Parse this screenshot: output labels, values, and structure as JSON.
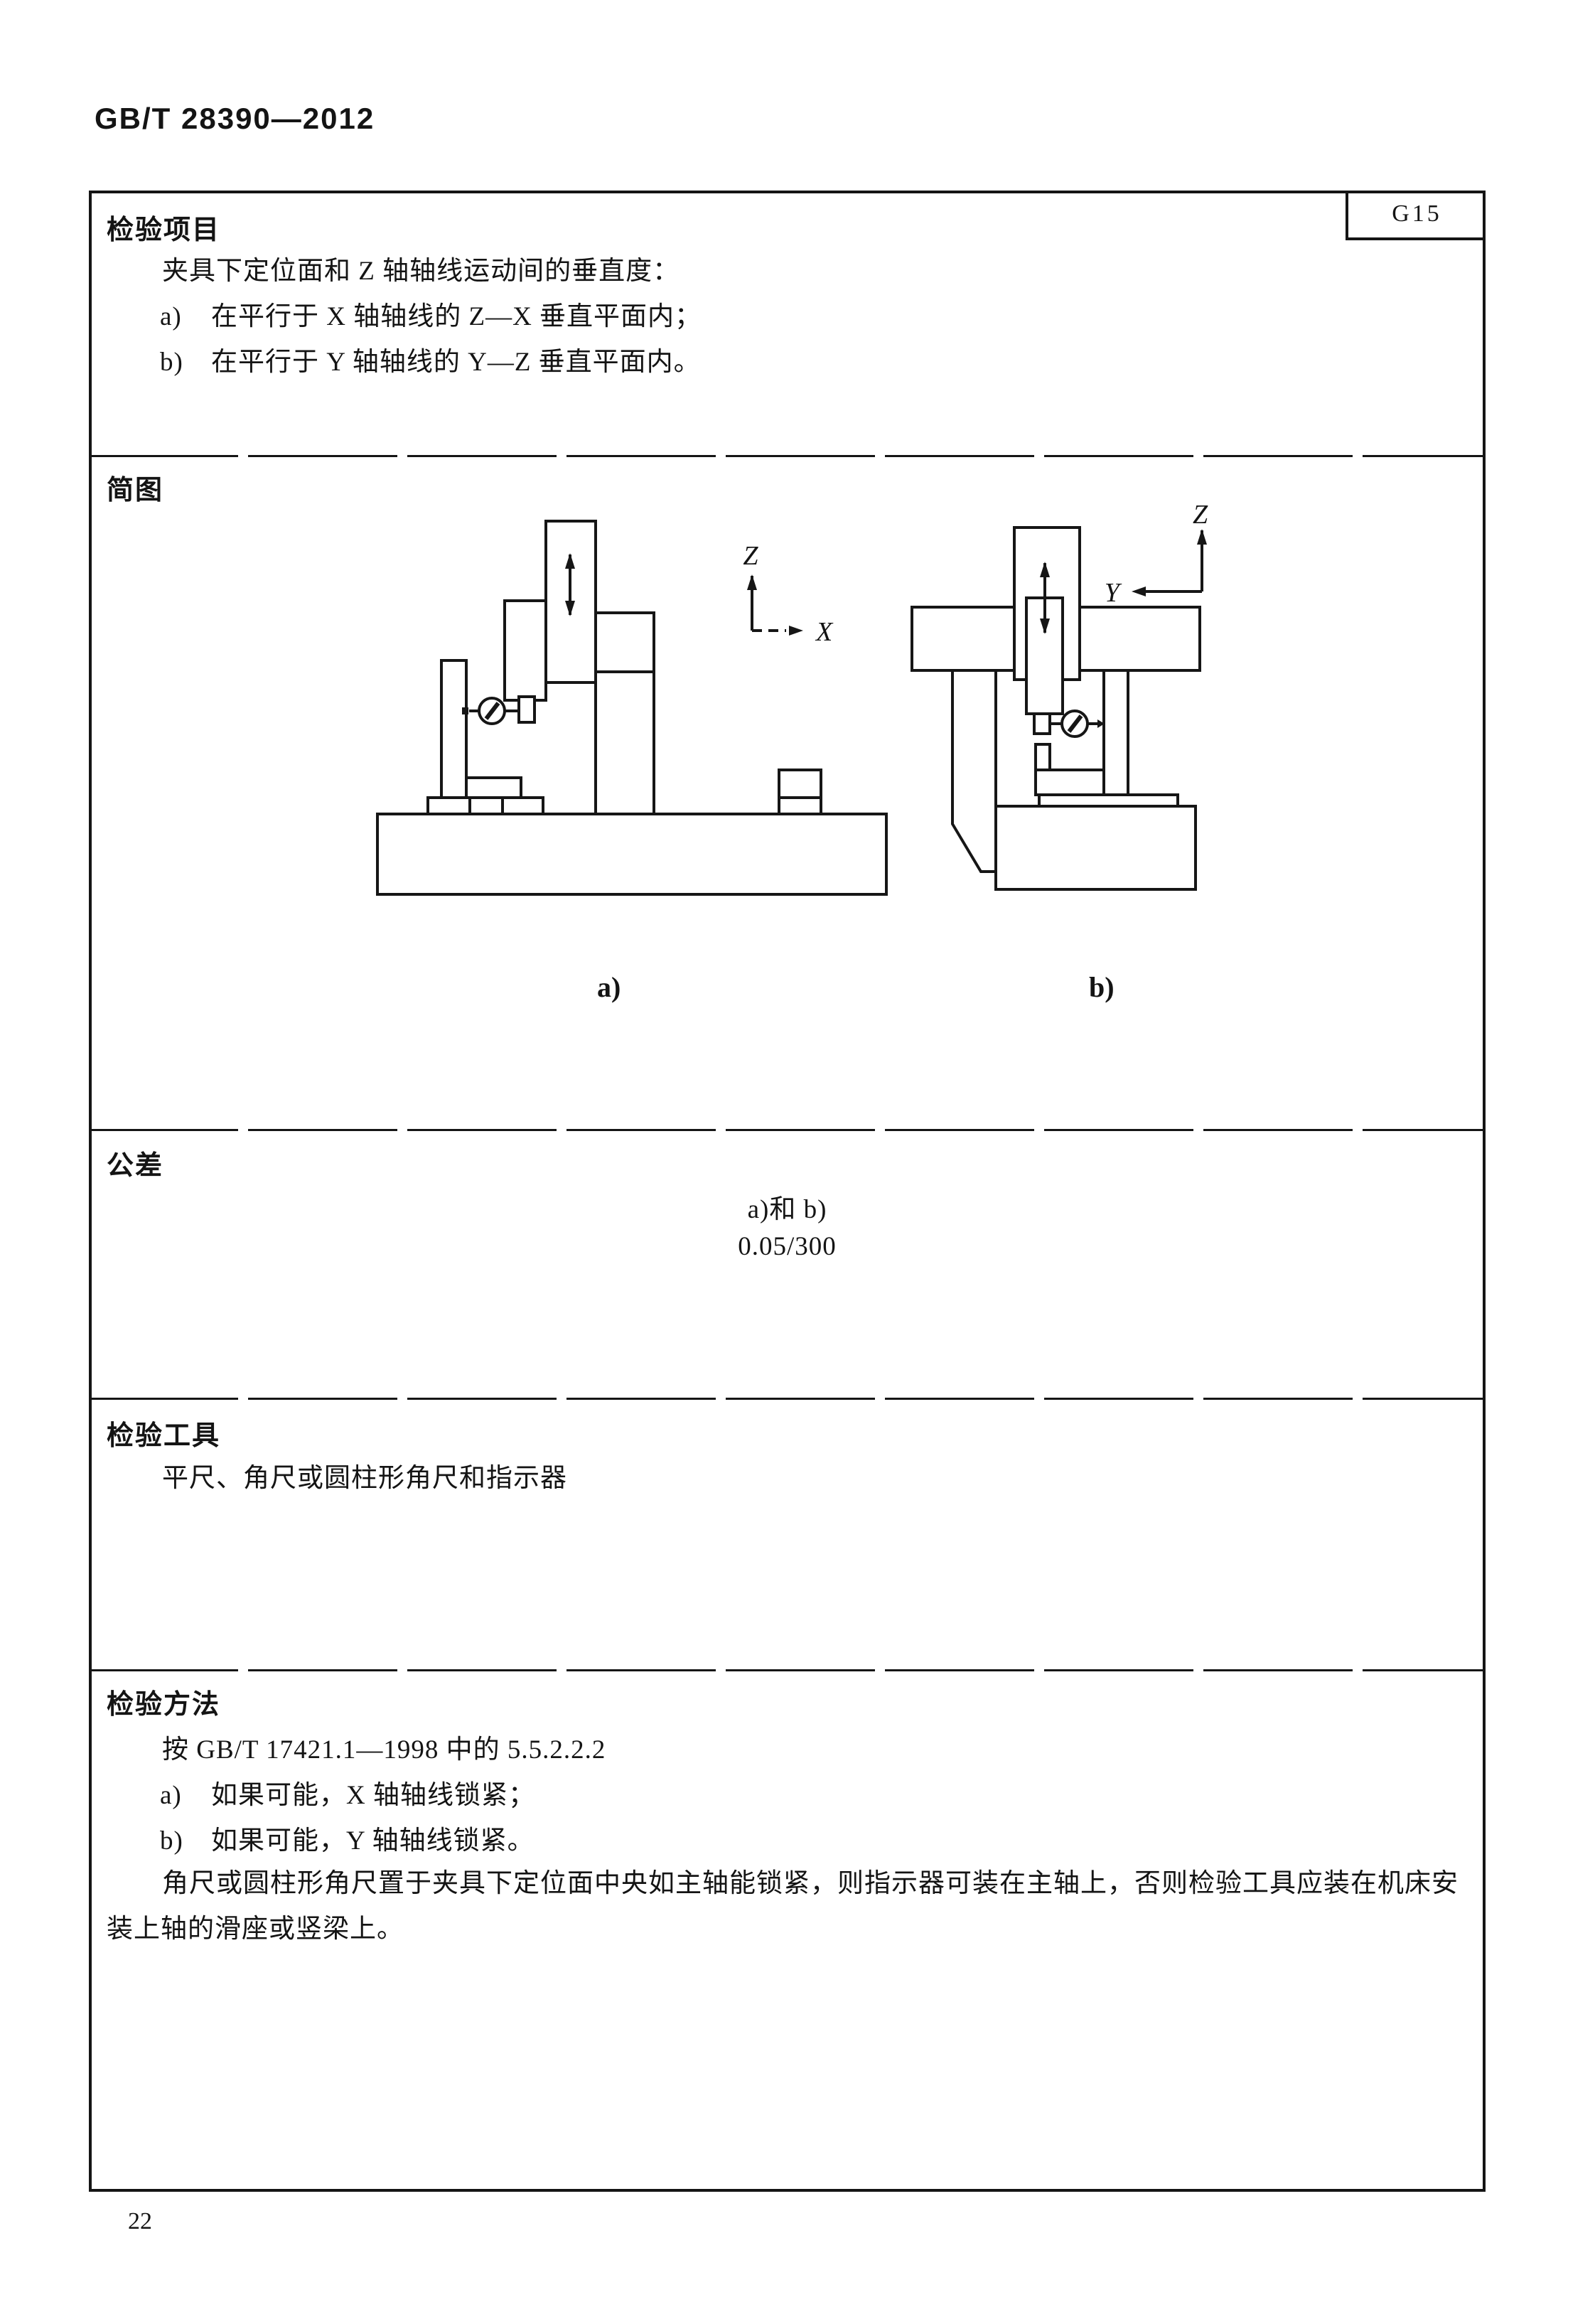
{
  "page": {
    "header_code": "GB/T 28390—2012",
    "page_number": "22"
  },
  "table": {
    "item_code": "G15",
    "inspection_item": {
      "title": "检验项目",
      "line1": "夹具下定位面和 Z 轴轴线运动间的垂直度：",
      "items": [
        {
          "marker": "a)",
          "text": "在平行于 X 轴轴线的 Z—X 垂直平面内；"
        },
        {
          "marker": "b)",
          "text": "在平行于 Y 轴轴线的 Y—Z 垂直平面内。"
        }
      ]
    },
    "diagram": {
      "title": "简图",
      "figure_a_label": "a)",
      "figure_b_label": "b)",
      "axes_a": {
        "vertical": "Z",
        "horizontal": "X"
      },
      "axes_b": {
        "vertical": "Z",
        "horizontal": "Y"
      }
    },
    "tolerance": {
      "title": "公差",
      "line1": "a)和 b)",
      "line2": "0.05/300"
    },
    "tools": {
      "title": "检验工具",
      "line1": "平尺、角尺或圆柱形角尺和指示器"
    },
    "method": {
      "title": "检验方法",
      "line1": "按 GB/T 17421.1—1998 中的 5.5.2.2.2",
      "items": [
        {
          "marker": "a)",
          "text": "如果可能，X 轴轴线锁紧；"
        },
        {
          "marker": "b)",
          "text": "如果可能，Y 轴轴线锁紧。"
        }
      ],
      "para_line1": "角尺或圆柱形角尺置于夹具下定位面中央如主轴能锁紧，则指示器可装在主轴上，否则检验工具应装在机床安",
      "para_line2": "装上轴的滑座或竖梁上。"
    }
  },
  "colors": {
    "ink": "#141414",
    "paper": "#ffffff"
  }
}
